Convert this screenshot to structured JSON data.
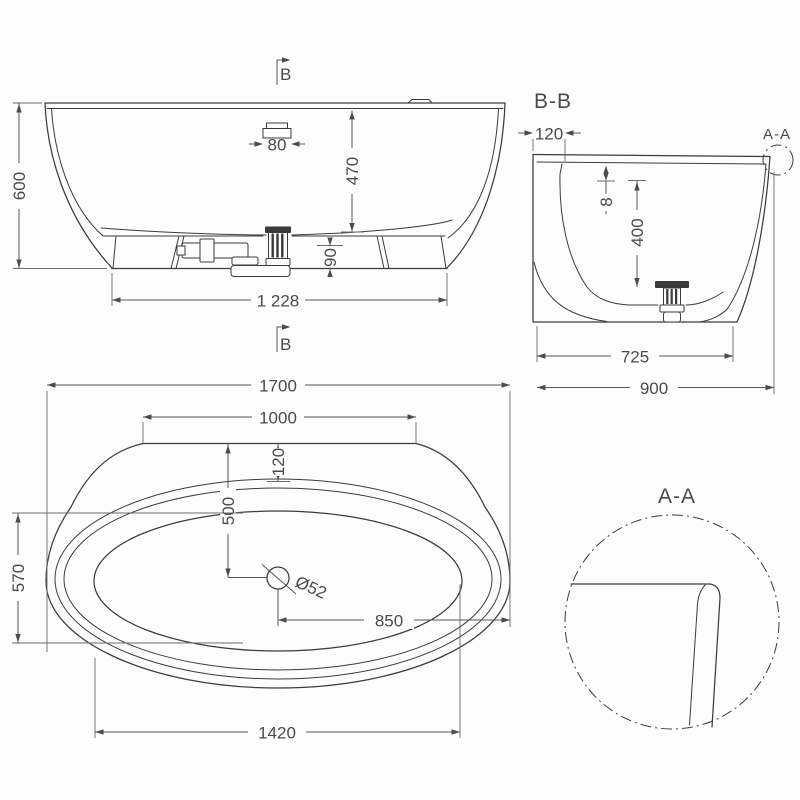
{
  "meta": {
    "background_color": "#fdfdfd",
    "object_line_color": "#3c3c3c",
    "dimension_line_color": "#575757",
    "text_color": "#4a4a4a"
  },
  "side": {
    "section_mark_top": "B",
    "section_mark_bottom": "B",
    "overall_height": "600",
    "overflow_width": "80",
    "inner_depth": "470",
    "outlet_height": "90",
    "base_length": "1 228"
  },
  "section_bb": {
    "title": "B-B",
    "detail_ref": "A-A",
    "deck_ledge": "120",
    "rim_thickness": "8",
    "basin_depth": "400",
    "base_width": "725",
    "overall_width": "900"
  },
  "plan": {
    "overall_length": "1700",
    "deck_length": "1000",
    "deck_offset": "120",
    "drain_to_center": "500",
    "drain_diameter": "Ø52",
    "drain_to_end": "850",
    "inner_width": "570",
    "inner_length": "1420"
  },
  "detail_aa": {
    "title": "A-A"
  }
}
